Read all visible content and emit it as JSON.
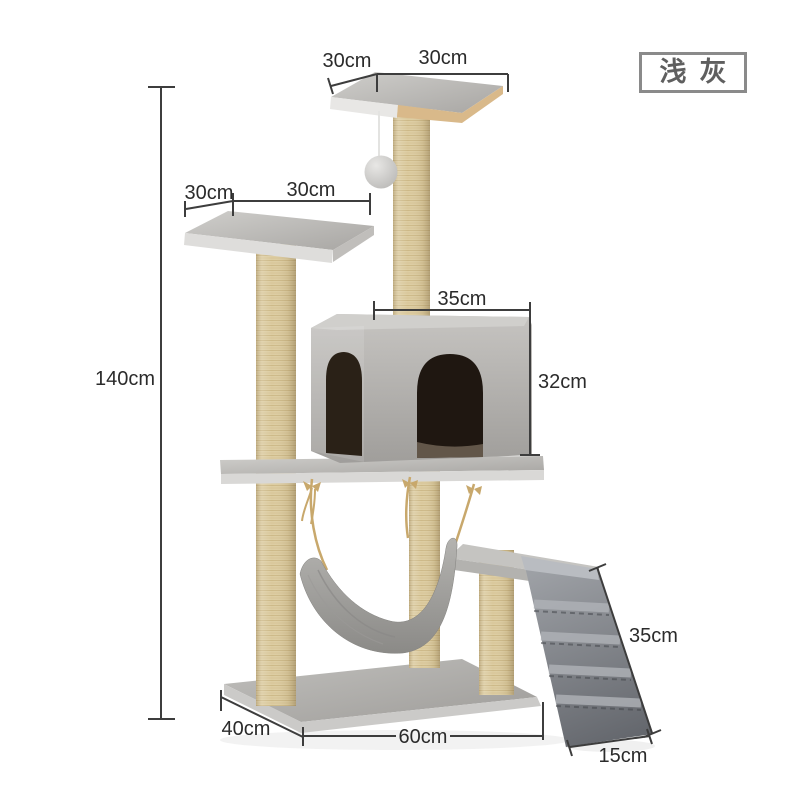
{
  "variant_label": "浅灰",
  "dimensions": {
    "height": "140cm",
    "top_platform_depth": "30cm",
    "top_platform_width": "30cm",
    "upper_platform_depth": "30cm",
    "upper_platform_width": "30cm",
    "condo_width": "35cm",
    "condo_height": "32cm",
    "base_depth": "40cm",
    "base_width": "60cm",
    "ramp_length": "35cm",
    "ramp_width": "15cm"
  },
  "colors": {
    "background": "#ffffff",
    "dimension_lines": "#3d3d3d",
    "dimension_text": "#2b2b2b",
    "variant_box_border": "#8a8a8a",
    "variant_text": "#5f5f5f",
    "sisal_post": "#ddcda2",
    "plush_gray": "#b5b3b0",
    "ramp_gray": "#73767c",
    "condo_opening": "#241b13",
    "rope": "#c8a86c",
    "wood": "#d9b98a"
  }
}
